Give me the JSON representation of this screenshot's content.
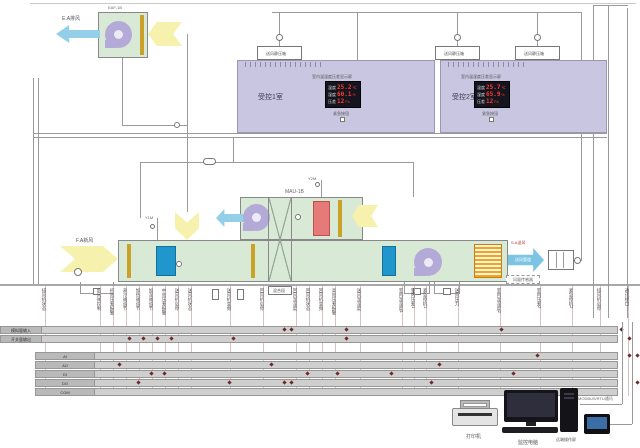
{
  "exhaust_fan": {
    "tag": "EAF-1B",
    "flow_label": "E.A排风"
  },
  "ahu": {
    "tag": "MAU-1B",
    "fresh_air_label": "F.A新风",
    "supply_air_label": "S.A送风",
    "supply_duct_text": "送风管道",
    "sensor_box_label": "风量传感器",
    "section_label": "混合段",
    "valve1": "Y1M",
    "valve2": "Y2M"
  },
  "plenum_box_label": "送风静压箱",
  "rooms": [
    {
      "name": "受控1室",
      "display_title": "室内温湿度压差显示屏",
      "button": "紧急按钮",
      "rows": [
        {
          "label": "温度",
          "value": "25.2",
          "unit": "℃"
        },
        {
          "label": "湿度",
          "value": "60.1",
          "unit": "%"
        },
        {
          "label": "压差",
          "value": "12",
          "unit": "Pa"
        }
      ]
    },
    {
      "name": "受控2室",
      "display_title": "室内温湿度压差显示屏",
      "button": "紧急按钮",
      "rows": [
        {
          "label": "温度",
          "value": "25.7",
          "unit": "℃"
        },
        {
          "label": "湿度",
          "value": "65.9",
          "unit": "%"
        },
        {
          "label": "压差",
          "value": "12",
          "unit": "Pa"
        }
      ]
    }
  ],
  "signals": [
    {
      "x": 45,
      "label": "排风机状态"
    },
    {
      "x": 100,
      "label": "新风阀控制"
    },
    {
      "x": 113,
      "label": "初效压差报警"
    },
    {
      "x": 126,
      "label": "表冷阀调节"
    },
    {
      "x": 139,
      "label": "加热阀调节"
    },
    {
      "x": 152,
      "label": "加湿阀调节"
    },
    {
      "x": 165,
      "label": "中效压差报警"
    },
    {
      "x": 178,
      "label": "送风机启停"
    },
    {
      "x": 191,
      "label": "送风机状态"
    },
    {
      "x": 230,
      "label": "送风机变频"
    },
    {
      "x": 263,
      "label": "回风机启停"
    },
    {
      "x": 296,
      "label": "回风温湿度"
    },
    {
      "x": 309,
      "label": "回风机状态"
    },
    {
      "x": 322,
      "label": "回风机变频"
    },
    {
      "x": 335,
      "label": "高效压差报警"
    },
    {
      "x": 360,
      "label": "送风温湿度"
    },
    {
      "x": 402,
      "label": "室内温湿度1"
    },
    {
      "x": 414,
      "label": "室内压差1"
    },
    {
      "x": 426,
      "label": "紧急停机1"
    },
    {
      "x": 458,
      "label": "送风压力"
    },
    {
      "x": 500,
      "label": "室内温湿度2"
    },
    {
      "x": 540,
      "label": "室内压差2"
    },
    {
      "x": 572,
      "label": "紧急停机2"
    },
    {
      "x": 600,
      "label": "排风机启停"
    },
    {
      "x": 628,
      "label": "通讯接口"
    }
  ],
  "bus": {
    "groupA": [
      {
        "label": "模拟量输入",
        "dots": [
          283,
          290,
          345,
          500,
          620
        ]
      },
      {
        "label": "开关量输出",
        "dots": [
          128,
          142,
          156,
          170,
          232,
          345,
          628
        ]
      }
    ],
    "groupB": [
      {
        "label": "AI",
        "dots": [
          536,
          628,
          636
        ]
      },
      {
        "label": "AO",
        "dots": [
          118,
          270,
          438
        ]
      },
      {
        "label": "DI",
        "dots": [
          150,
          163,
          306,
          336,
          390,
          512
        ]
      },
      {
        "label": "DO",
        "dots": [
          137,
          228,
          283,
          290,
          430,
          636
        ]
      },
      {
        "label": "COM",
        "dots": []
      }
    ]
  },
  "devices": {
    "printer": "打印机",
    "pc": "监控电脑",
    "hmi": "远端操作屏",
    "bus_label": "MODBUS/RTU通讯"
  }
}
